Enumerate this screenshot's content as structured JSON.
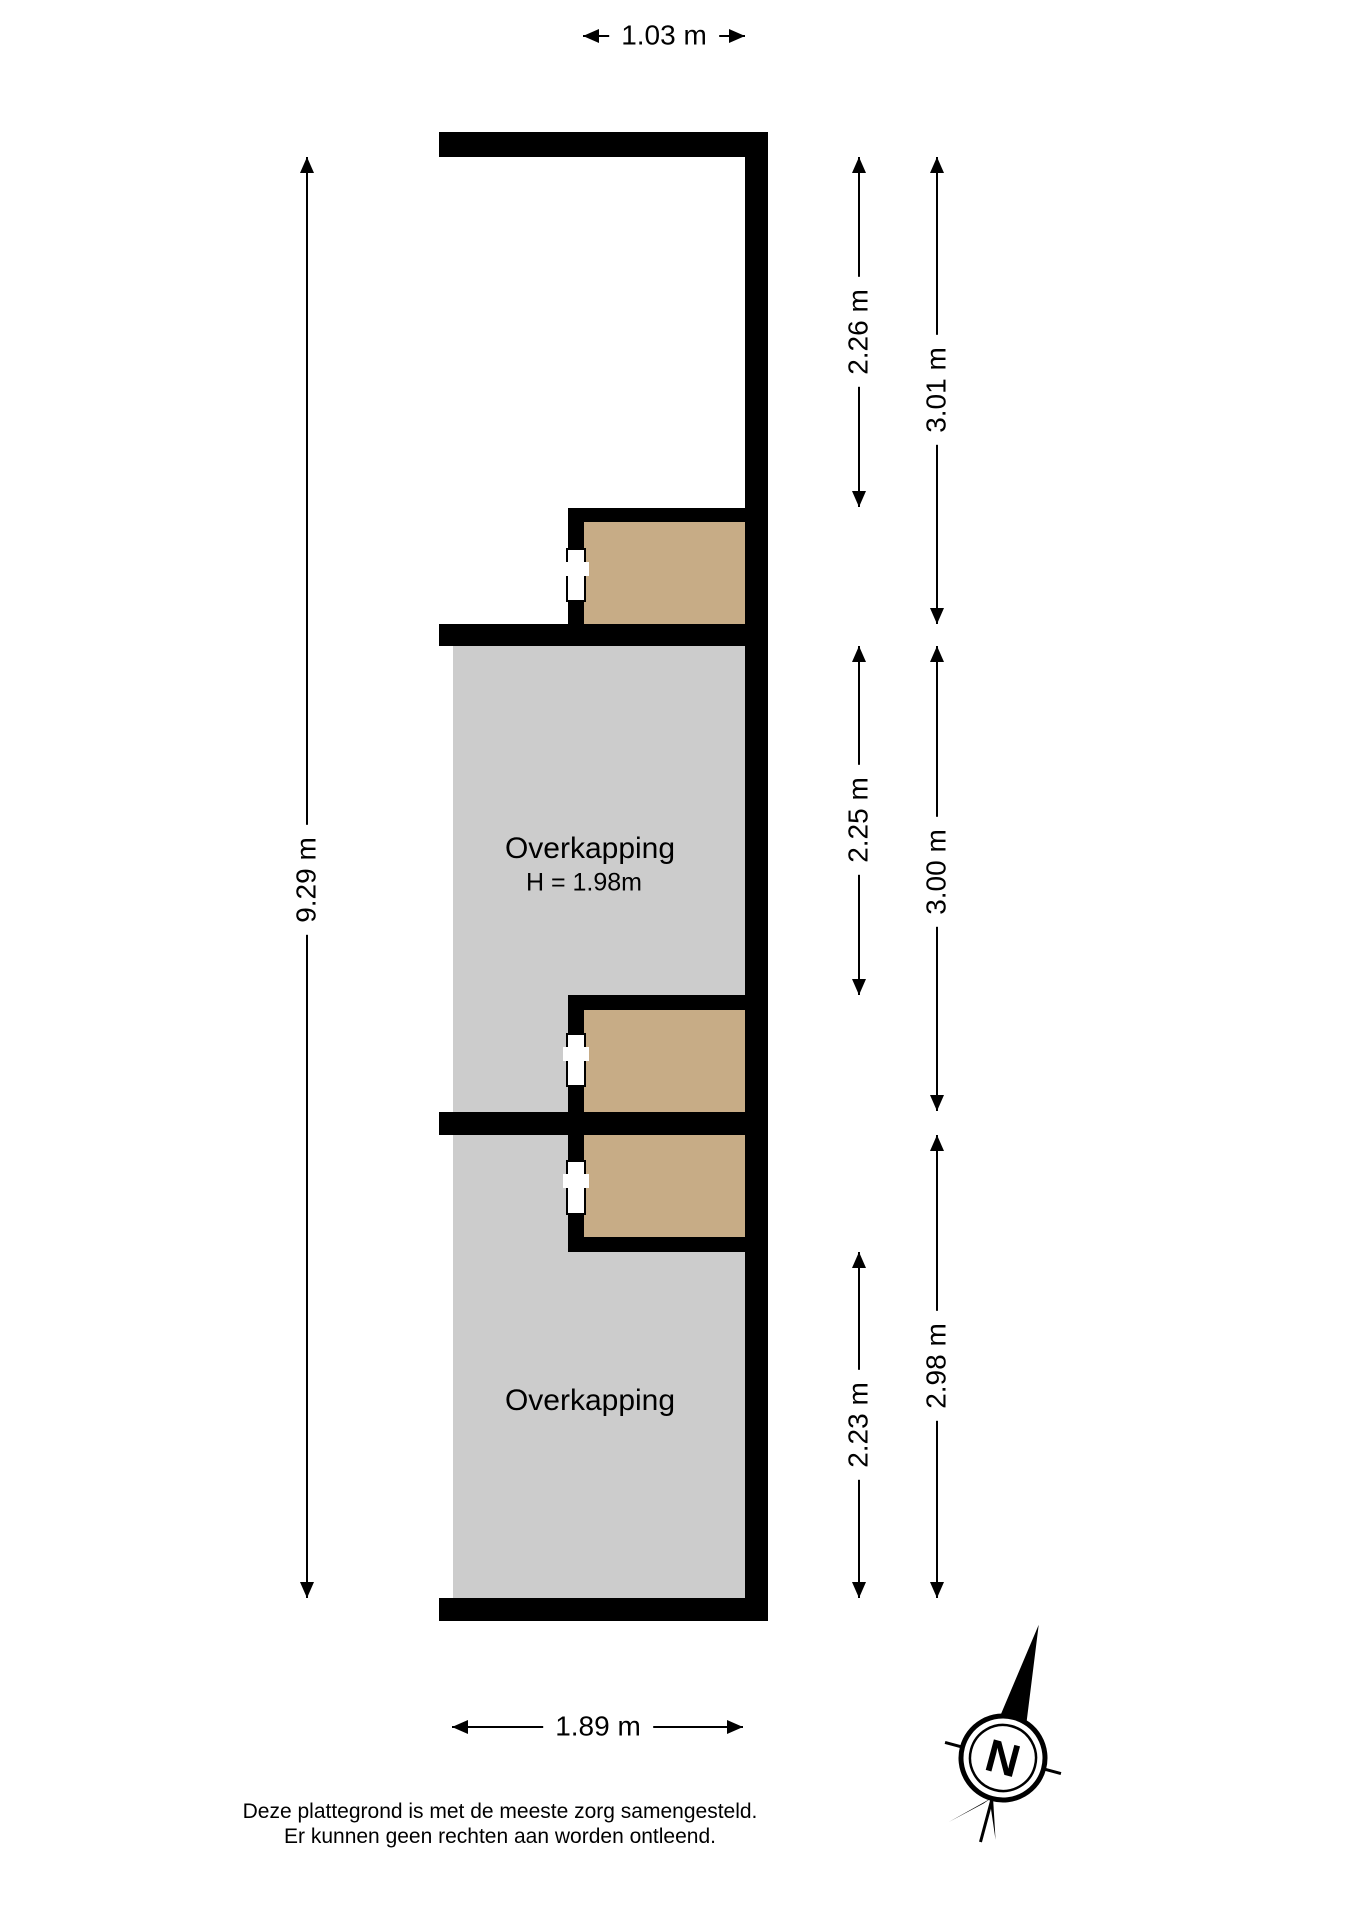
{
  "plan": {
    "type": "floorplan",
    "rooms": {
      "overkapping_1": {
        "name": "Overkapping",
        "height": "H = 1.98m"
      },
      "overkapping_2": {
        "name": "Overkapping"
      }
    },
    "dimensions": {
      "top": "1.03 m",
      "bottom": "1.89 m",
      "left": "9.29 m",
      "right_inner": [
        "2.26 m",
        "2.25 m",
        "2.23 m"
      ],
      "right_outer": [
        "3.01 m",
        "3.00 m",
        "2.98 m"
      ]
    }
  },
  "compass": {
    "north": "N"
  },
  "footer": {
    "line1": "Deze plattegrond is met de meeste zorg samengesteld.",
    "line2": "Er kunnen geen rechten aan worden ontleend."
  },
  "colors": {
    "wall": "#000000",
    "covered_area": "#CCCCCC",
    "shed_area": "#C7AC86",
    "dimension_line": "#000000",
    "background": "#FFFFFF"
  }
}
